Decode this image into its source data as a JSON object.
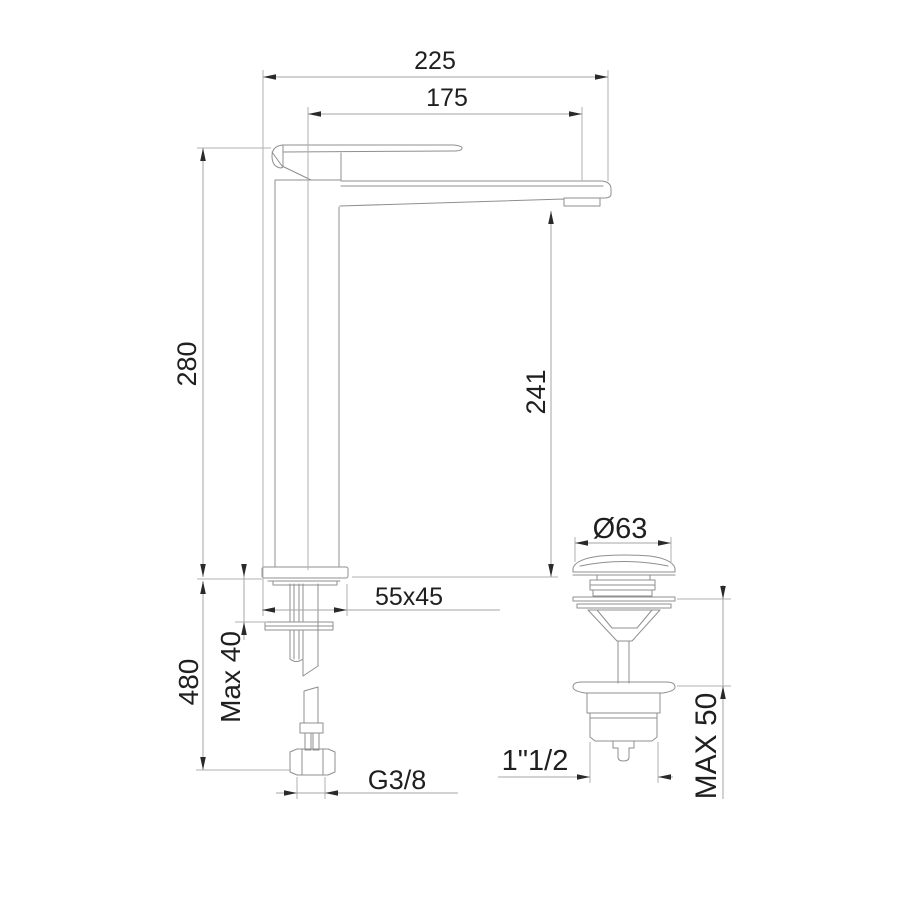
{
  "drawing": {
    "background": "#ffffff",
    "object_line_color": "#8f8f8f",
    "dimension_line_color": "#a6a6a6",
    "arrow_color": "#2a2a2a",
    "text_color": "#1f1f1f"
  },
  "dimensions": {
    "depth_overall": "225",
    "spout_reach": "175",
    "height_above_deck": "280",
    "spout_outlet_height": "241",
    "base_plate": "55x45",
    "deck_thickness_max": "Max 40",
    "overall_height": "480",
    "supply_thread": "G3/8",
    "drain_cap_diameter": "Ø63",
    "drain_thread": "1\"1/2",
    "drain_deck_max": "MAX 50"
  }
}
